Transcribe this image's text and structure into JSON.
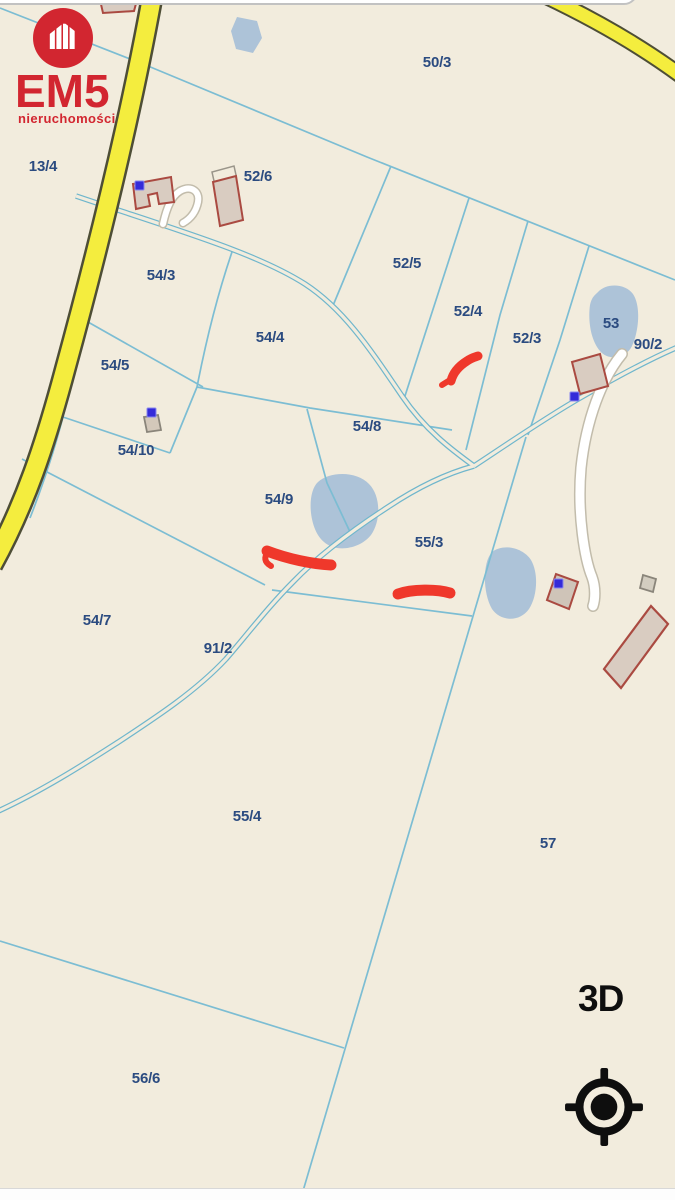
{
  "map": {
    "type": "cadastral-parcel-map",
    "parcel_labels": [
      "50/3",
      "13/4",
      "52/6",
      "54/3",
      "52/5",
      "52/4",
      "52/3",
      "53",
      "90/2",
      "54/4",
      "54/5",
      "54/8",
      "54/10",
      "54/9",
      "55/3",
      "54/7",
      "91/2",
      "55/4",
      "57",
      "56/6"
    ],
    "colors": {
      "background": "#f2ecdd",
      "parcel_line": "#7cbdd3",
      "label": "#2b4b80",
      "road_yellow": "#f4ed3e",
      "road_casing": "#4e4e36",
      "water": "#adc3d8",
      "building_fill": "#d9ccc1",
      "building_outline": "#aa4a41",
      "highlight_red": "#ef382b",
      "poi_marker_blue": "#342bd9"
    },
    "icons": {
      "poi_marker": "blue-square-marker-icon",
      "highlight": "red-paint-stroke-highlight"
    }
  },
  "logo": {
    "brand": "EM5",
    "tagline": "nieruchomości",
    "icon": "house-icon",
    "color": "#d22630"
  },
  "controls": {
    "view_3d_label": "3D",
    "locate_icon": "crosshair-locate-icon"
  }
}
